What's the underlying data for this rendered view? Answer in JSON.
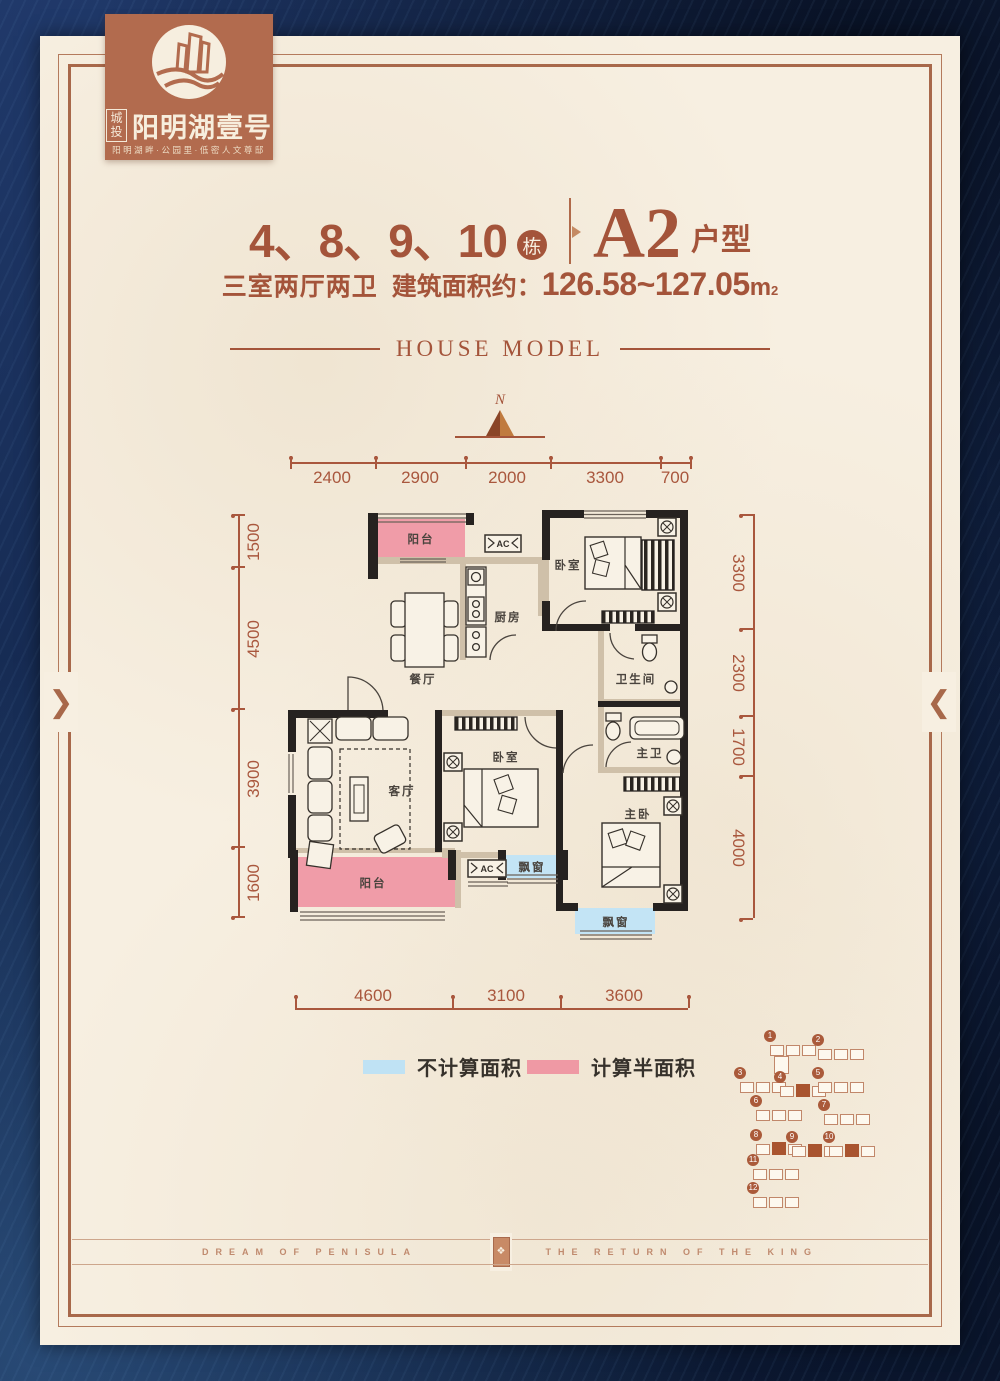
{
  "logo": {
    "emblem_icon": "buildings-over-wave-icon",
    "brand_prefix": "城投",
    "brand_name": "阳明湖壹号",
    "tagline": "阳明湖畔·公园里·低密人文尊邸"
  },
  "header": {
    "building_numbers": "4、8、9、10",
    "building_unit_badge": "栋",
    "plan_code": "A2",
    "plan_code_suffix": "户型",
    "spec": "三室两厅两卫",
    "area_label": "建筑面积约：",
    "area_value": "126.58~127.05",
    "area_unit": "m",
    "area_sup": "2",
    "section_title": "HOUSE MODEL"
  },
  "compass": {
    "north_label": "N"
  },
  "plan": {
    "dims_top": [
      "2400",
      "2900",
      "2000",
      "3300",
      "700"
    ],
    "dims_left": [
      "1500",
      "4500",
      "3900",
      "1600"
    ],
    "dims_right": [
      "3300",
      "2300",
      "1700",
      "4000"
    ],
    "dims_bottom": [
      "4600",
      "3100",
      "3600"
    ],
    "rooms": {
      "balcony_top": "阳台",
      "kitchen": "厨房",
      "bedroom1": "卧室",
      "dining": "餐厅",
      "bathroom": "卫生间",
      "living": "客厅",
      "bedroom2": "卧室",
      "master_bath": "主卫",
      "master_bedroom": "主卧",
      "balcony_bottom": "阳台",
      "bay_window1": "飘窗",
      "bay_window2": "飘窗",
      "ac_top": "AC",
      "ac_bottom": "AC"
    }
  },
  "legend": {
    "not_counted_label": "不计算面积",
    "not_counted_color": "#bfe2f4",
    "half_counted_label": "计算半面积",
    "half_counted_color": "#ef99a4"
  },
  "site_plan": {
    "buildings": [
      {
        "label": "1",
        "highlighted": false
      },
      {
        "label": "2",
        "highlighted": false
      },
      {
        "label": "3",
        "highlighted": false
      },
      {
        "label": "4",
        "highlighted": true
      },
      {
        "label": "5",
        "highlighted": false
      },
      {
        "label": "6",
        "highlighted": false
      },
      {
        "label": "7",
        "highlighted": false
      },
      {
        "label": "8",
        "highlighted": true
      },
      {
        "label": "9",
        "highlighted": true
      },
      {
        "label": "10",
        "highlighted": true
      },
      {
        "label": "11",
        "highlighted": false
      },
      {
        "label": "12",
        "highlighted": false
      }
    ]
  },
  "footer": {
    "left_text": "DREAM OF PENISULA",
    "right_text": "THE RETURN OF THE KING",
    "ornament_icon": "floral-cartouche-icon"
  },
  "colors": {
    "accent_brown": "#a4543a",
    "page_cream": "#f7efe1",
    "border_navy": "#13264c",
    "wall_black": "#262220",
    "wall_beige": "#cfc0a9",
    "balcony_pink": "#f09ca8",
    "bay_blue": "#c3e4f5"
  }
}
